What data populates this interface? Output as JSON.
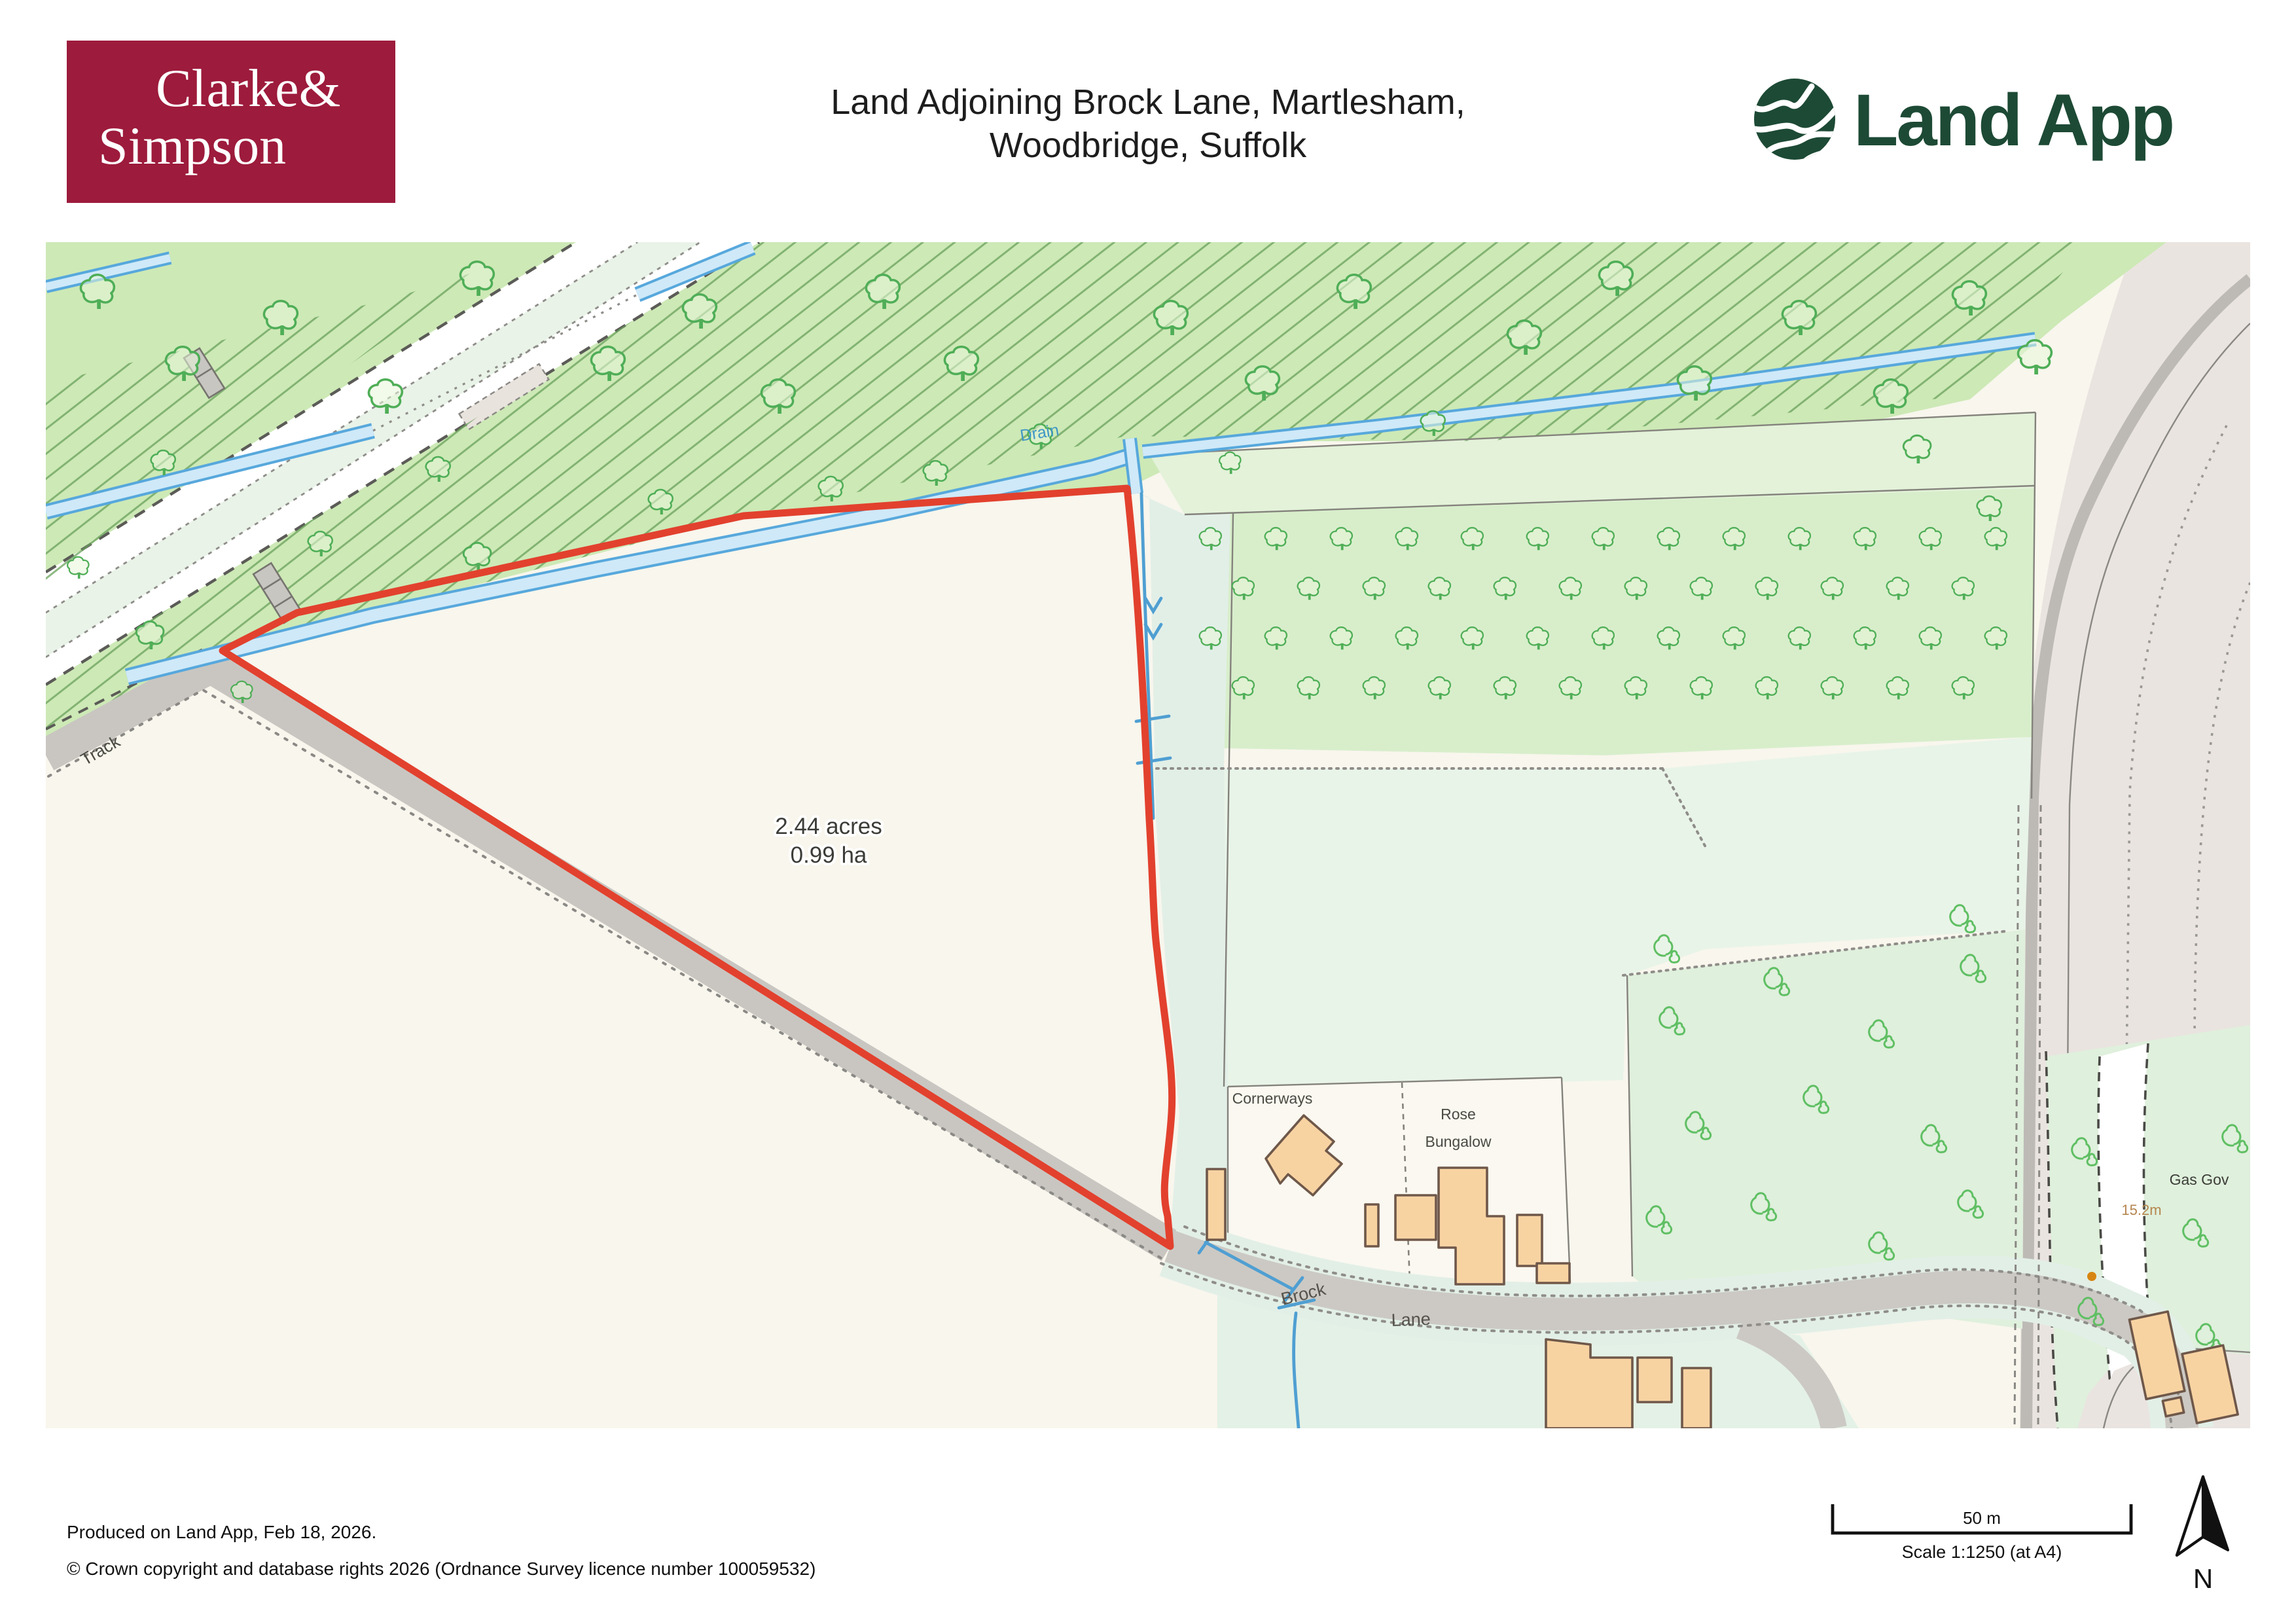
{
  "header": {
    "cs_line1": "Clarke&",
    "cs_line2": "Simpson",
    "title_line1": "Land Adjoining Brock Lane, Martlesham,",
    "title_line2": "Woodbridge, Suffolk",
    "land_app": "Land App"
  },
  "map": {
    "area_line1": "2.44 acres",
    "area_line2": "0.99 ha",
    "labels": {
      "track": "Track",
      "drain": "Drain",
      "brock": "Brock",
      "lane": "Lane",
      "cornerways": "Cornerways",
      "rose1": "Rose",
      "rose2": "Bungalow",
      "gas_gov": "Gas Gov",
      "height": "15.2m"
    }
  },
  "footer": {
    "produced": "Produced on Land App, Feb 18, 2026.",
    "copyright": "© Crown copyright and database rights 2026 (Ordnance Survey licence number 100059532)",
    "scale_value": "50 m",
    "scale_text": "Scale 1:1250 (at A4)",
    "north": "N"
  },
  "colors": {
    "brand_red": "#9d1b3c",
    "land_app_green": "#1d4a35",
    "boundary_red": "#e2412e",
    "woodland_green": "#cde9b6",
    "water_blue": "#57a8dc",
    "building_orange": "#f8d3a2"
  }
}
